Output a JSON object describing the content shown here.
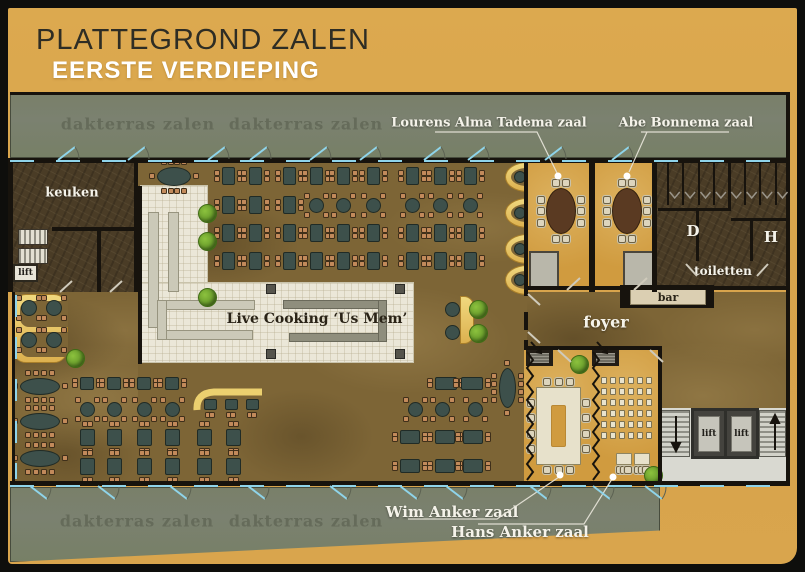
{
  "page": {
    "title": "PLATTEGROND ZALEN",
    "subtitle": "EERSTE VERDIEPING"
  },
  "colors": {
    "background_gold": "#d9a54d",
    "frame": "#0e0e0c",
    "terrace_green": "#7b8170",
    "terrace_label": "#656b5a",
    "floor_brown": "#7d6536",
    "dark_room_brown": "#4a3c26",
    "meeting_room_gold": "#d09b3f",
    "table_teal": "#3d504b",
    "chair_tan": "#c28a5b",
    "buffet_cream": "#ebe7d8",
    "door_blue": "#8fd4ea",
    "booth_yellow": "#ecd06f",
    "label_white": "#f5f3ea"
  },
  "labels": {
    "terrace_top_left": "dakterras zalen",
    "terrace_top_right": "dakterras zalen",
    "terrace_bottom_left": "dakterras zalen",
    "terrace_bottom_right": "dakterras zalen",
    "room_alma_tadema": "Lourens Alma Tadema zaal",
    "room_abe_bonnema": "Abe Bonnema zaal",
    "room_wim_anker": "Wim Anker zaal",
    "room_hans_anker": "Hans Anker zaal",
    "kitchen": "keuken",
    "foyer": "foyer",
    "bar": "bar",
    "toilets": "toiletten",
    "toilet_ladies": "D",
    "toilet_gents": "H",
    "live_cooking": "Live Cooking ‘Us Mem’",
    "lift_small": "lift",
    "lift_left": "lift",
    "lift_right": "lift"
  },
  "furniture": {
    "tables": [
      [
        228,
        176,
        13,
        18,
        "r",
        "lr"
      ],
      [
        255,
        176,
        13,
        18,
        "r",
        "lr"
      ],
      [
        289,
        176,
        13,
        18,
        "r",
        "lr"
      ],
      [
        316,
        176,
        13,
        18,
        "r",
        "lr"
      ],
      [
        343,
        176,
        13,
        18,
        "r",
        "lr"
      ],
      [
        373,
        176,
        13,
        18,
        "r",
        "lr"
      ],
      [
        412,
        176,
        13,
        18,
        "r",
        "lr"
      ],
      [
        440,
        176,
        13,
        18,
        "r",
        "lr"
      ],
      [
        470,
        176,
        13,
        18,
        "r",
        "lr"
      ],
      [
        228,
        205,
        13,
        18,
        "r",
        "lr"
      ],
      [
        255,
        205,
        13,
        18,
        "r",
        "lr"
      ],
      [
        289,
        205,
        13,
        18,
        "r",
        "lr"
      ],
      [
        316,
        205,
        15,
        15,
        "c",
        "d4"
      ],
      [
        343,
        205,
        15,
        15,
        "c",
        "d4"
      ],
      [
        373,
        205,
        15,
        15,
        "c",
        "d4"
      ],
      [
        412,
        205,
        15,
        15,
        "c",
        "d4"
      ],
      [
        440,
        205,
        15,
        15,
        "c",
        "d4"
      ],
      [
        470,
        205,
        15,
        15,
        "c",
        "d4"
      ],
      [
        228,
        233,
        13,
        18,
        "r",
        "lr"
      ],
      [
        255,
        233,
        13,
        18,
        "r",
        "lr"
      ],
      [
        289,
        233,
        13,
        18,
        "r",
        "lr"
      ],
      [
        316,
        233,
        13,
        18,
        "r",
        "lr"
      ],
      [
        343,
        233,
        13,
        18,
        "r",
        "lr"
      ],
      [
        373,
        233,
        13,
        18,
        "r",
        "lr"
      ],
      [
        412,
        233,
        13,
        18,
        "r",
        "lr"
      ],
      [
        440,
        233,
        13,
        18,
        "r",
        "lr"
      ],
      [
        470,
        233,
        13,
        18,
        "r",
        "lr"
      ],
      [
        228,
        261,
        13,
        18,
        "r",
        "lr"
      ],
      [
        255,
        261,
        13,
        18,
        "r",
        "lr"
      ],
      [
        289,
        261,
        13,
        18,
        "r",
        "lr"
      ],
      [
        316,
        261,
        13,
        18,
        "r",
        "lr"
      ],
      [
        343,
        261,
        13,
        18,
        "r",
        "lr"
      ],
      [
        373,
        261,
        13,
        18,
        "r",
        "lr"
      ],
      [
        412,
        261,
        13,
        18,
        "r",
        "lr"
      ],
      [
        440,
        261,
        13,
        18,
        "r",
        "lr"
      ],
      [
        470,
        261,
        13,
        18,
        "r",
        "lr"
      ],
      [
        174,
        176,
        34,
        19,
        "o",
        "ar"
      ],
      [
        87,
        383,
        14,
        13,
        "r",
        "lr"
      ],
      [
        114,
        383,
        14,
        13,
        "r",
        "lr"
      ],
      [
        144,
        383,
        14,
        13,
        "r",
        "lr"
      ],
      [
        172,
        383,
        14,
        13,
        "r",
        "lr"
      ],
      [
        446,
        383,
        22,
        13,
        "r",
        "lr"
      ],
      [
        472,
        383,
        22,
        13,
        "r",
        "lr"
      ],
      [
        87,
        409,
        15,
        15,
        "c",
        "d4"
      ],
      [
        114,
        409,
        15,
        15,
        "c",
        "d4"
      ],
      [
        144,
        409,
        15,
        15,
        "c",
        "d4"
      ],
      [
        172,
        409,
        15,
        15,
        "c",
        "d4"
      ],
      [
        415,
        409,
        15,
        15,
        "c",
        "d4"
      ],
      [
        442,
        409,
        15,
        15,
        "c",
        "d4"
      ],
      [
        475,
        409,
        15,
        15,
        "c",
        "d4"
      ],
      [
        87,
        437,
        15,
        17,
        "r",
        "tb"
      ],
      [
        114,
        437,
        15,
        17,
        "r",
        "tb"
      ],
      [
        144,
        437,
        15,
        17,
        "r",
        "tb"
      ],
      [
        172,
        437,
        15,
        17,
        "r",
        "tb"
      ],
      [
        204,
        437,
        15,
        17,
        "r",
        "tb"
      ],
      [
        233,
        437,
        15,
        17,
        "r",
        "tb"
      ],
      [
        410,
        437,
        20,
        14,
        "r",
        "lr"
      ],
      [
        445,
        437,
        20,
        14,
        "r",
        "lr"
      ],
      [
        473,
        437,
        20,
        14,
        "r",
        "lr"
      ],
      [
        87,
        466,
        15,
        17,
        "r",
        "tb"
      ],
      [
        114,
        466,
        15,
        17,
        "r",
        "tb"
      ],
      [
        144,
        466,
        15,
        17,
        "r",
        "tb"
      ],
      [
        172,
        466,
        15,
        17,
        "r",
        "tb"
      ],
      [
        204,
        466,
        15,
        17,
        "r",
        "tb"
      ],
      [
        233,
        466,
        15,
        17,
        "r",
        "tb"
      ],
      [
        410,
        466,
        20,
        14,
        "r",
        "lr"
      ],
      [
        445,
        466,
        20,
        14,
        "r",
        "lr"
      ],
      [
        473,
        466,
        20,
        14,
        "r",
        "lr"
      ],
      [
        40,
        386,
        40,
        17,
        "o",
        "ar"
      ],
      [
        40,
        421,
        40,
        17,
        "o",
        "ar"
      ],
      [
        40,
        458,
        40,
        17,
        "o",
        "ar"
      ],
      [
        507,
        388,
        17,
        40,
        "o",
        "arv"
      ],
      [
        210,
        404,
        13,
        11,
        "r",
        "b"
      ],
      [
        231,
        404,
        13,
        11,
        "r",
        "b"
      ],
      [
        252,
        404,
        13,
        11,
        "r",
        "b"
      ],
      [
        29,
        308,
        16,
        16,
        "c",
        "d4"
      ],
      [
        54,
        308,
        16,
        16,
        "c",
        "d4"
      ],
      [
        29,
        340,
        16,
        16,
        "c",
        "d4"
      ],
      [
        54,
        340,
        16,
        16,
        "c",
        "d4"
      ],
      [
        452,
        309,
        15,
        15,
        "c",
        "n"
      ],
      [
        452,
        332,
        15,
        15,
        "c",
        "n"
      ],
      [
        561,
        211,
        30,
        46,
        "o",
        "mt"
      ],
      [
        627,
        211,
        30,
        46,
        "o",
        "mt"
      ],
      [
        624,
        459,
        16,
        12,
        "k",
        "b3"
      ],
      [
        642,
        459,
        16,
        12,
        "k",
        "b3"
      ]
    ],
    "theater": {
      "x0": 601,
      "y0": 377,
      "cols": 6,
      "rows": 6,
      "dx": 9,
      "dy": 11
    },
    "u_table": {
      "x": 536,
      "y": 387,
      "w": 45,
      "h": 78,
      "hx": 551,
      "hy": 405,
      "hw": 15,
      "hh": 42
    },
    "plants": [
      [
        206,
        212
      ],
      [
        206,
        240
      ],
      [
        206,
        296
      ],
      [
        74,
        357
      ],
      [
        477,
        308
      ],
      [
        477,
        332
      ],
      [
        578,
        363
      ],
      [
        652,
        474
      ]
    ],
    "pillars": [
      [
        270,
        288
      ],
      [
        399,
        288
      ],
      [
        270,
        353
      ],
      [
        399,
        353
      ]
    ],
    "wall_booths": [
      177,
      213,
      249,
      280
    ],
    "stalls": {
      "x0": 667,
      "dx": 15.4,
      "n": 8,
      "y": 163,
      "h": 42
    },
    "doors_top": [
      58,
      128,
      208,
      250,
      310,
      360,
      424,
      468,
      545,
      612
    ],
    "doors_bottom": [
      30,
      98,
      170,
      248,
      330,
      400,
      446,
      530,
      593,
      645
    ]
  }
}
